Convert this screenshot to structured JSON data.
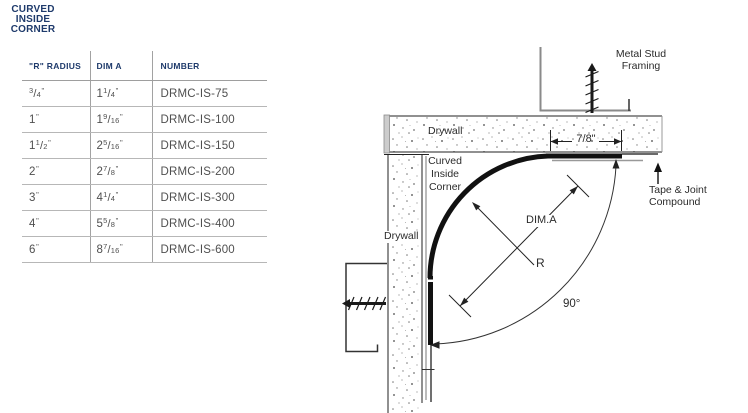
{
  "title": {
    "lines": [
      "CURVED",
      "INSIDE",
      "CORNER"
    ]
  },
  "table": {
    "headers": [
      "\"R\" RADIUS",
      "DIM A",
      "NUMBER"
    ],
    "rows": [
      {
        "radius": {
          "whole": "",
          "num": "3",
          "den": "4"
        },
        "dim_a": {
          "whole": "1",
          "num": "1",
          "den": "4"
        },
        "number": "DRMC-IS-75"
      },
      {
        "radius": {
          "whole": "1"
        },
        "dim_a": {
          "whole": "1",
          "num": "9",
          "den": "16"
        },
        "number": "DRMC-IS-100"
      },
      {
        "radius": {
          "whole": "1",
          "num": "1",
          "den": "2"
        },
        "dim_a": {
          "whole": "2",
          "num": "5",
          "den": "16"
        },
        "number": "DRMC-IS-150"
      },
      {
        "radius": {
          "whole": "2"
        },
        "dim_a": {
          "whole": "2",
          "num": "7",
          "den": "8"
        },
        "number": "DRMC-IS-200"
      },
      {
        "radius": {
          "whole": "3"
        },
        "dim_a": {
          "whole": "4",
          "num": "1",
          "den": "4"
        },
        "number": "DRMC-IS-300"
      },
      {
        "radius": {
          "whole": "4"
        },
        "dim_a": {
          "whole": "5",
          "num": "5",
          "den": "8"
        },
        "number": "DRMC-IS-400"
      },
      {
        "radius": {
          "whole": "6"
        },
        "dim_a": {
          "whole": "8",
          "num": "7",
          "den": "16"
        },
        "number": "DRMC-IS-600"
      }
    ],
    "unit_mark": "\""
  },
  "diagram": {
    "labels": {
      "metal_stud": [
        "Metal Stud",
        "Framing"
      ],
      "drywall_top": "Drywall",
      "curved_corner": [
        "Curved",
        "Inside",
        "Corner"
      ],
      "drywall_side": "Drywall",
      "tape_joint": [
        "Tape & Joint",
        "Compound"
      ],
      "dim_width": "7/8\"",
      "dim_a": "DIM.A",
      "radius": "R",
      "angle": "90°"
    }
  },
  "colors": {
    "navy": "#1e3a6b",
    "cell_text": "#4f4f4f",
    "grid_line": "#a2a2a2",
    "drawing_line": "#1a1a1a",
    "metal_gray": "#8a8a8a"
  }
}
